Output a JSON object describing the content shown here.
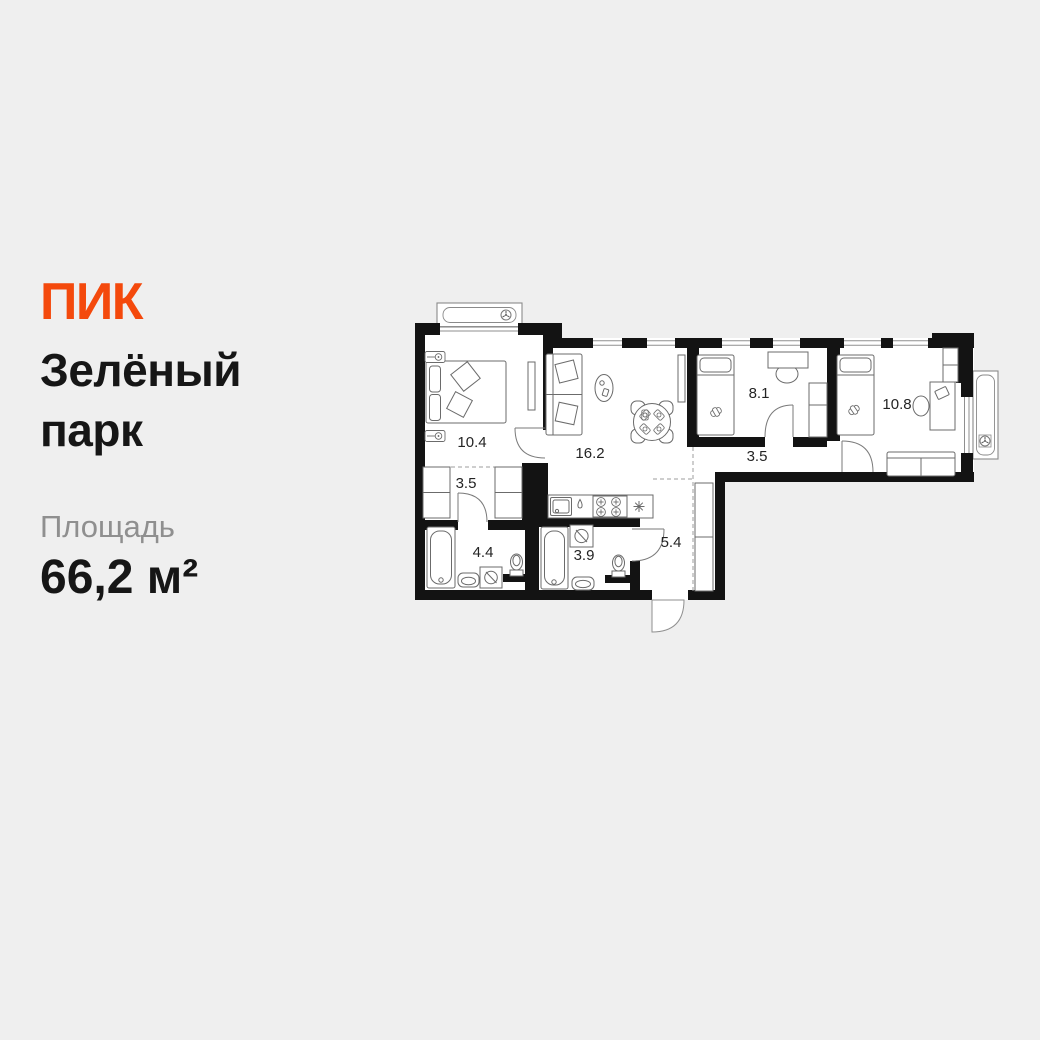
{
  "background": "#efefef",
  "brand": {
    "logo_text": "ПИК",
    "color": "#f4490c"
  },
  "listing": {
    "title_line1": "Зелёный",
    "title_line2": "парк",
    "area_label": "Площадь",
    "area_value": "66,2 м²"
  },
  "floorplan": {
    "wall_color": "#131313",
    "rooms": [
      {
        "name": "bedroom-main",
        "area": "10.4"
      },
      {
        "name": "living-kitchen",
        "area": "16.2"
      },
      {
        "name": "bedroom-2",
        "area": "8.1"
      },
      {
        "name": "bedroom-3",
        "area": "10.8"
      },
      {
        "name": "wardrobe-corridor",
        "area": "3.5"
      },
      {
        "name": "corridor",
        "area": "3.5"
      },
      {
        "name": "bathroom-1",
        "area": "4.4"
      },
      {
        "name": "bathroom-2",
        "area": "3.9"
      },
      {
        "name": "hallway",
        "area": "5.4"
      }
    ]
  }
}
